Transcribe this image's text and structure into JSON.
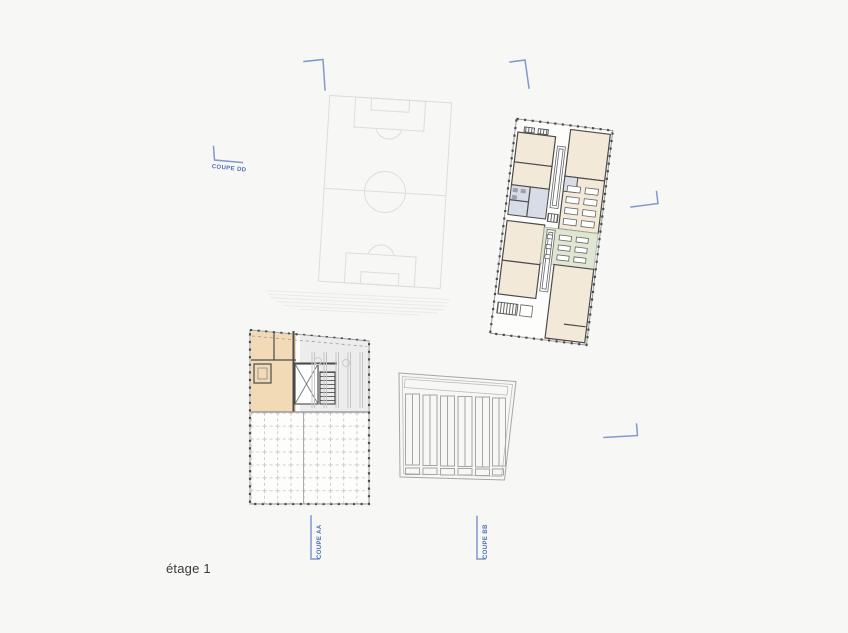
{
  "sheet": {
    "background": "#f7f7f5"
  },
  "title": {
    "floor_label": "étage 1"
  },
  "sections": [
    {
      "id": "dd",
      "label": "COUPE DD"
    },
    {
      "id": "aa",
      "label": "COUPE AA"
    },
    {
      "id": "bb",
      "label": "COUPE BB"
    }
  ],
  "colors": {
    "page_bg": "#f7f7f5",
    "accent_blue": "#4f6db5",
    "mark_blue": "#8299cc",
    "wall_dark": "#4b4b4b",
    "room_beige": "#f3e9d8",
    "room_orange": "#f3dab6",
    "zone_green": "#dfe6d2",
    "wet_blue": "#d7dce6",
    "field_gray": "#dddddd",
    "bleacher_gray": "#e8e8e8",
    "grid_gray": "#c3c3c3",
    "parking_gray": "#a6a6a6",
    "light_gray_fill": "#ececed",
    "text_dark": "#3a3a3a"
  }
}
